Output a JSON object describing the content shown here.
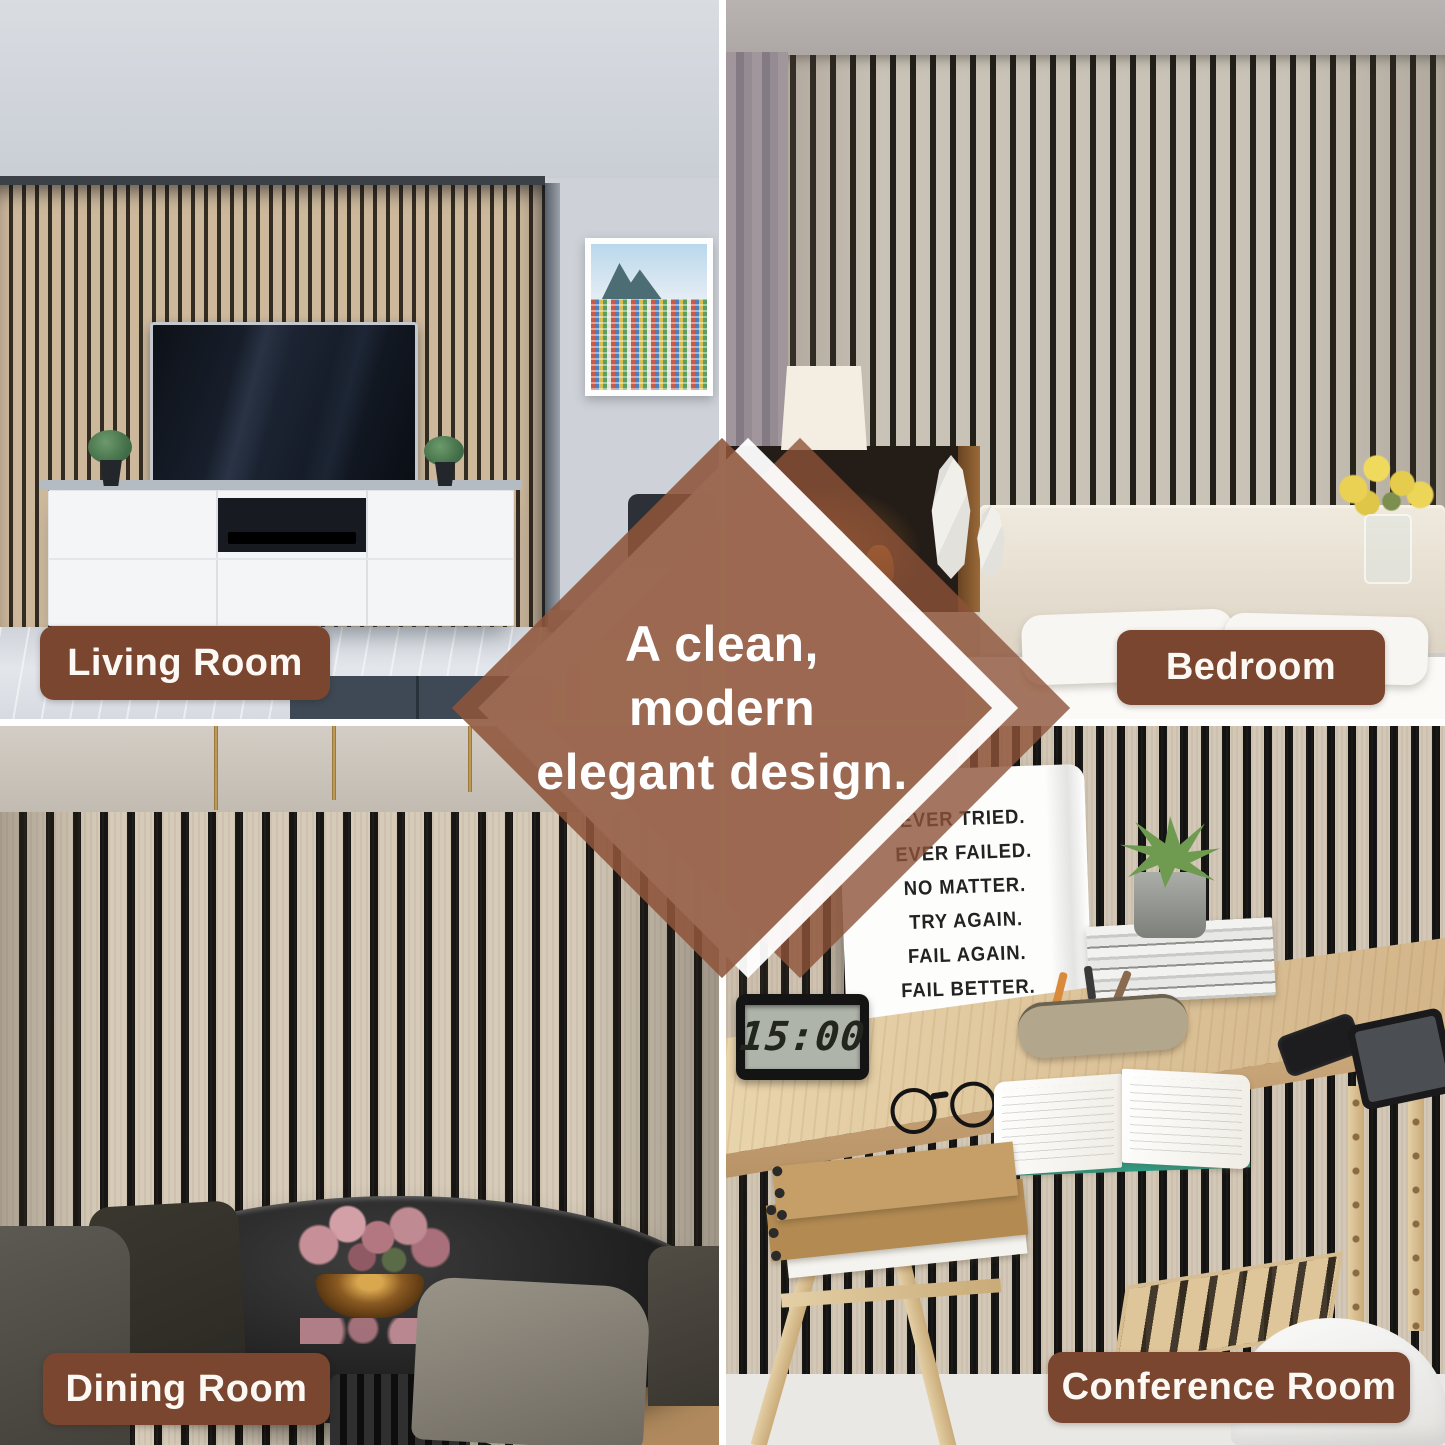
{
  "diamond": {
    "lines": [
      "A clean,",
      "modern",
      "elegant design."
    ],
    "overlay_color": "#8e5439",
    "text_color": "#ffffff"
  },
  "style": {
    "label_bg": "#7a4630",
    "label_text": "#ffffff",
    "gutter": "#ffffff",
    "slat_wood": "#cdb89c",
    "slat_gap": "#1a1815"
  },
  "rooms": {
    "living": {
      "label": "Living Room"
    },
    "bedroom": {
      "label": "Bedroom"
    },
    "dining": {
      "label": "Dining Room"
    },
    "conference": {
      "label": "Conference Room",
      "poster_lines": [
        "EVER TRIED.",
        "EVER FAILED.",
        "NO MATTER.",
        "TRY AGAIN.",
        "FAIL AGAIN.",
        "FAIL BETTER."
      ],
      "clock_time": "15:00"
    }
  }
}
